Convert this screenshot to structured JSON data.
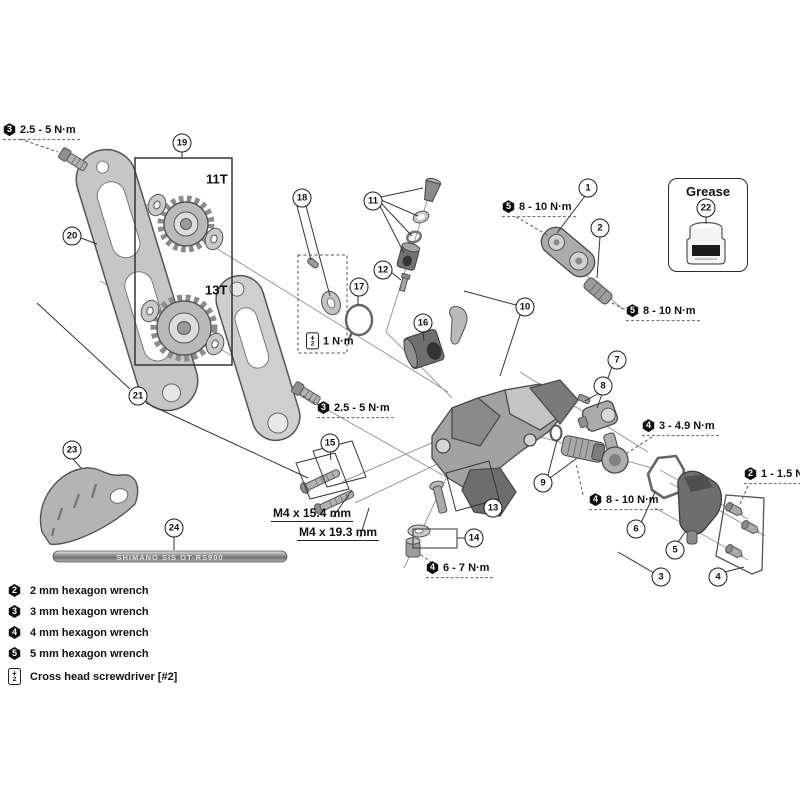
{
  "figure": {
    "grease_title": "Grease",
    "cable_text": "SHIMANO SIS OT-RS900"
  },
  "callouts": [
    {
      "n": "1",
      "x": 588,
      "y": 188
    },
    {
      "n": "2",
      "x": 600,
      "y": 228
    },
    {
      "n": "3",
      "x": 661,
      "y": 577
    },
    {
      "n": "4",
      "x": 718,
      "y": 577
    },
    {
      "n": "5",
      "x": 675,
      "y": 550
    },
    {
      "n": "6",
      "x": 636,
      "y": 529
    },
    {
      "n": "7",
      "x": 617,
      "y": 360
    },
    {
      "n": "8",
      "x": 603,
      "y": 386
    },
    {
      "n": "9",
      "x": 543,
      "y": 483
    },
    {
      "n": "10",
      "x": 525,
      "y": 307
    },
    {
      "n": "11",
      "x": 373,
      "y": 201
    },
    {
      "n": "12",
      "x": 383,
      "y": 270
    },
    {
      "n": "13",
      "x": 493,
      "y": 508
    },
    {
      "n": "14",
      "x": 474,
      "y": 538
    },
    {
      "n": "15",
      "x": 330,
      "y": 443
    },
    {
      "n": "16",
      "x": 423,
      "y": 323
    },
    {
      "n": "17",
      "x": 359,
      "y": 287
    },
    {
      "n": "18",
      "x": 302,
      "y": 198
    },
    {
      "n": "19",
      "x": 182,
      "y": 143
    },
    {
      "n": "20",
      "x": 72,
      "y": 236
    },
    {
      "n": "21",
      "x": 138,
      "y": 396
    },
    {
      "n": "22",
      "x": 706,
      "y": 208
    },
    {
      "n": "23",
      "x": 72,
      "y": 450
    },
    {
      "n": "24",
      "x": 174,
      "y": 528
    }
  ],
  "torque_labels": [
    {
      "tool": "3",
      "text": "2.5 - 5 N·m",
      "x": 3,
      "y": 133
    },
    {
      "tool": "3",
      "text": "2.5 - 5 N·m",
      "x": 317,
      "y": 411
    },
    {
      "tool": "5",
      "text": "8 - 10 N·m",
      "x": 502,
      "y": 210
    },
    {
      "tool": "5",
      "text": "8 - 10 N·m",
      "x": 626,
      "y": 314
    },
    {
      "tool": "4",
      "text": "3 - 4.9 N·m",
      "x": 642,
      "y": 429
    },
    {
      "tool": "4",
      "text": "8 - 10 N·m",
      "x": 589,
      "y": 503
    },
    {
      "tool": "2",
      "text": "1 - 1.5 N·m",
      "x": 744,
      "y": 477
    },
    {
      "tool": "4",
      "text": "6 - 7 N·m",
      "x": 426,
      "y": 571
    },
    {
      "tool": "+",
      "sub": "2",
      "text": "1 N·m",
      "x": 306,
      "y": 344,
      "cls": "ph no-ul"
    }
  ],
  "size_labels": [
    {
      "text": "M4 x 15.4 mm",
      "x": 271,
      "y": 514
    },
    {
      "text": "M4 x 19.3 mm",
      "x": 297,
      "y": 533
    }
  ],
  "pulley_labels": [
    {
      "text": "11T",
      "x": 206,
      "y": 179
    },
    {
      "text": "13T",
      "x": 205,
      "y": 290
    }
  ],
  "legend": [
    {
      "icon": "2",
      "label": "2 mm hexagon wrench"
    },
    {
      "icon": "3",
      "label": "3 mm hexagon wrench"
    },
    {
      "icon": "4",
      "label": "4 mm hexagon wrench"
    },
    {
      "icon": "5",
      "label": "5 mm hexagon wrench"
    },
    {
      "icon": "+",
      "icon_sub": "2",
      "label": "Cross head screwdriver [#2]",
      "cls": "ph"
    }
  ]
}
